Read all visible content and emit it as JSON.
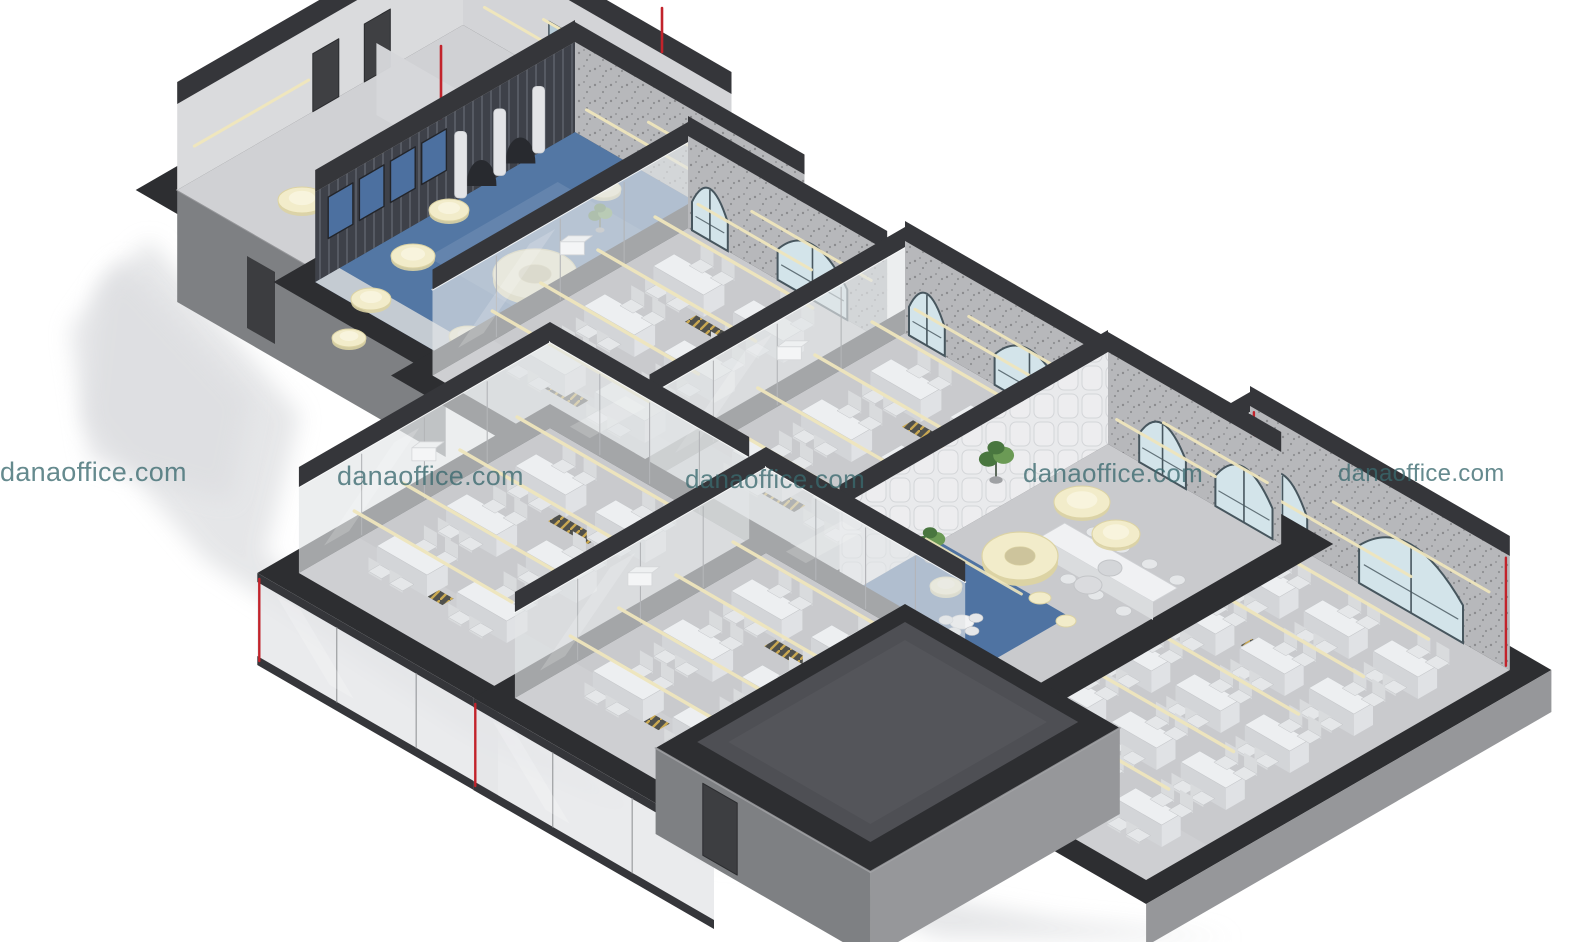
{
  "watermark": {
    "text": "danaoffice.com",
    "instances": 5,
    "color": "rgba(58,105,110,0.78)"
  },
  "palette": {
    "background": "#ffffff",
    "shadow": "#e3e4e6",
    "cap_dark": "#2d2e31",
    "cap_dark2": "#35363a",
    "exterior_left": "#7e8083",
    "exterior_right": "#96979a",
    "roof_inner": "#54555a",
    "floor": "#c9cacd",
    "floor_wing": "#d0d1d4",
    "floor_light": "#dcdde0",
    "blue_carpet": "#5377a4",
    "blue_carpet2": "#4f73a2",
    "booth_wall": "#3e4149",
    "booth_blue": "#4c70a0",
    "curtain": "#e3e4e7",
    "glass_wall": "rgba(226,229,231,0.66)",
    "glass_frame": "#b3b5b8",
    "window_glass": "#d3e4ea",
    "mullion": "#47565e",
    "speckle_base": "#b7b8bb",
    "pad_base": "#e9eaec",
    "cream": "#f2ecca",
    "cream_edge": "#dcd3a4",
    "cream_strip": "#efe6bd",
    "desk_top": "#edeff1",
    "desk_side": "#d3d5d8",
    "chair": "#e5e7e9",
    "chair_back": "#d9dbdd",
    "white_box": "#f4f5f6",
    "red_accent": "#c2232b",
    "plant_green": "#49763f",
    "plant_green2": "#6b9a55",
    "hatch_gold": "#c9a23c"
  },
  "scene": {
    "type": "isometric-3d-office-floorplan-render",
    "rooms": [
      {
        "id": "wc-elevator-core",
        "lights": 4
      },
      {
        "id": "phone-booth-lounge",
        "booths": 4,
        "ring_sofas": 1,
        "pendant_discs": 7
      },
      {
        "id": "open-office-a",
        "desks": 6
      },
      {
        "id": "open-office-b",
        "desks": 6
      },
      {
        "id": "meeting-lounge",
        "ring_pendants": 1,
        "dome_pendants": 2,
        "meeting_tables": 1
      },
      {
        "id": "open-office-large",
        "desks": 15
      },
      {
        "id": "open-office-c",
        "desks": 6
      },
      {
        "id": "open-office-d",
        "desks": 6
      },
      {
        "id": "entrance-block",
        "doors": 1
      }
    ]
  }
}
